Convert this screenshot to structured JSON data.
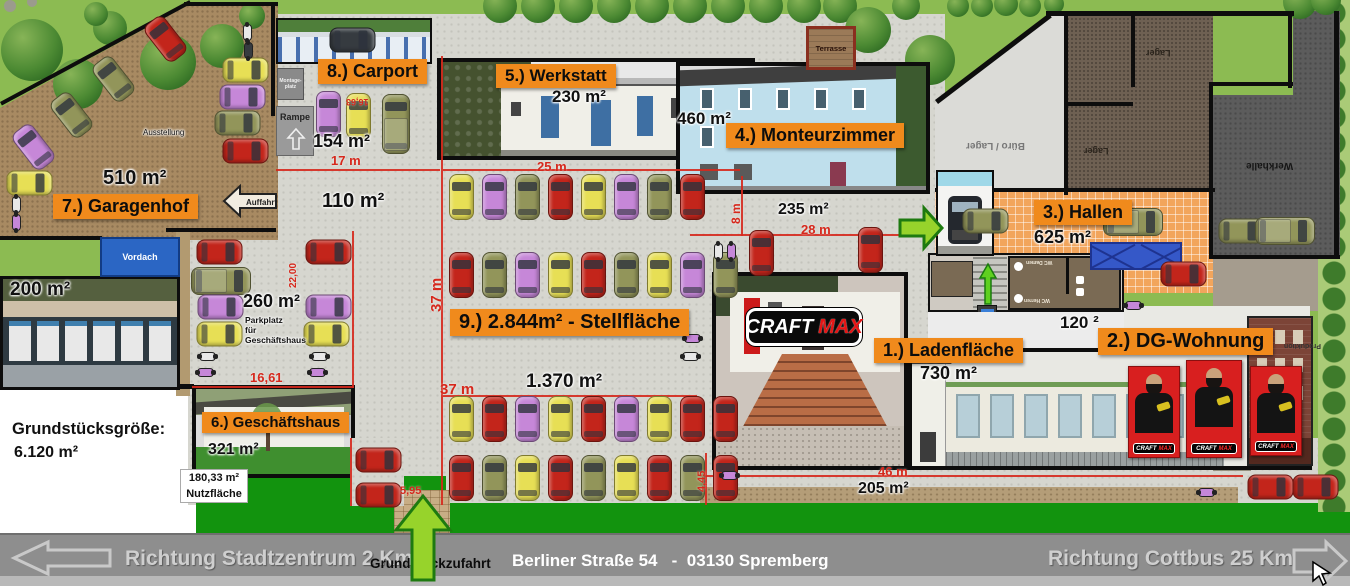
{
  "areas": {
    "ladenflaeche": {
      "badge": "1.) Ladenfläche",
      "area": "730 m²"
    },
    "dg_wohnung": {
      "badge": "2.) DG-Wohnung",
      "area": "120 ²"
    },
    "hallen": {
      "badge": "3.) Hallen",
      "area": "625 m²"
    },
    "monteurzimmer": {
      "badge": "4.) Monteurzimmer",
      "area": "460 m²"
    },
    "werkstatt": {
      "badge": "5.) Werkstatt",
      "area": "230 m²"
    },
    "geschaeftshaus": {
      "badge": "6.) Geschäftshaus",
      "area": "321 m²",
      "note1": "180,33 m²",
      "note2": "Nutzfläche"
    },
    "garagenhof": {
      "badge": "7.) Garagenhof",
      "area": "510 m²"
    },
    "carport": {
      "badge": "8.) Carport",
      "area": "154 m²"
    },
    "stellflaeche": {
      "badge": "9.) 2.844m² - Stellfläche",
      "area": "1.370 m²"
    }
  },
  "plot": {
    "label": "Grundstücksgröße:",
    "size": "6.120 m²"
  },
  "zones": {
    "ausstellung": "Ausstellung",
    "rampe": "Rampe",
    "montage1": "Montage-",
    "montage2": "platz",
    "auffahrt": "Auffahrt",
    "vordach": "Vordach",
    "terrasse": "Terrasse",
    "area200": "200 m²",
    "area110": "110 m²",
    "area260": "260 m²",
    "parkplatz1": "Parkplatz",
    "parkplatz2": "für",
    "parkplatz3": "Geschäftshaus",
    "area235": "235 m²",
    "area205": "205 m²",
    "buero_lager": "Büro / Lager",
    "lager": "Lager",
    "werkhalle": "Werkhalle",
    "produktion": "Produktion",
    "wc_damen": "WC Damen",
    "wc_herren": "WC Herren"
  },
  "dims": {
    "d17": "17 m",
    "d25": "25 m",
    "d28": "28 m",
    "d8": "8 m",
    "d37v": "37 m",
    "d37h": "37 m",
    "d46": "46 m",
    "d1661": "16,61",
    "d2200": "22,00",
    "d595": "5,95",
    "d445": "4,45",
    "d438": "4,38",
    "d383": "3,83",
    "d1663": "16,63"
  },
  "brand": {
    "craft": "CRAFT",
    "max": "MAX"
  },
  "footer": {
    "left": "Richtung Stadtzentrum 2 Km",
    "entrance": "Grundstückzufahrt",
    "address": "Berliner Straße 54   -  03130 Spremberg",
    "right": "Richtung Cottbus 25 Km"
  },
  "colors": {
    "badge": "#F08A1C",
    "dim_red": "#D6281C",
    "grass": "#8CBB52",
    "lawn_dark": "#12930E",
    "road": "#8E8E8E",
    "arrow_green": "#97D32B"
  }
}
